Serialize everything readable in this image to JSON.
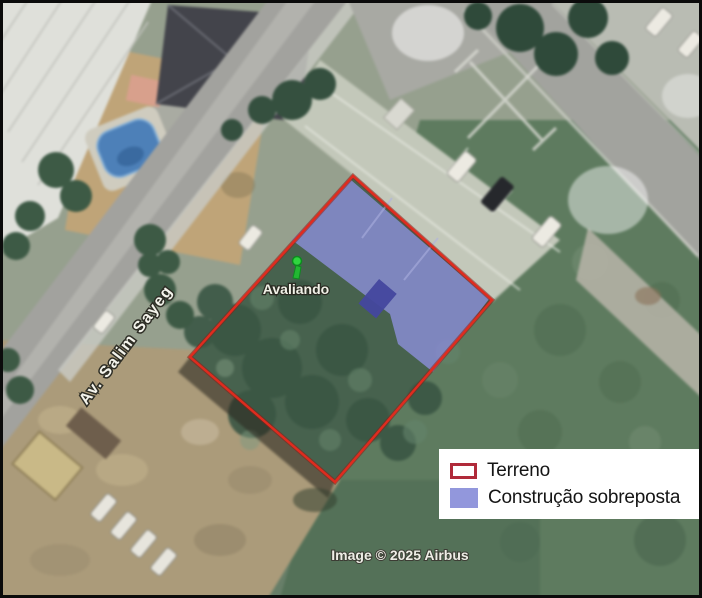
{
  "map": {
    "marker_label": "Avaliando",
    "street_label": "Av. Salim Sayeg",
    "attribution": "Image © 2025 Airbus"
  },
  "legend": {
    "items": [
      {
        "label": "Terreno",
        "swatch": "red-outline"
      },
      {
        "label": "Construção sobreposta",
        "swatch": "purple-fill"
      }
    ]
  },
  "colors": {
    "terreno_outline": "#e02b1e",
    "terreno_outline_halo": "#8f1a12",
    "construction_fill": "#868bce",
    "construction_dark": "#44479e",
    "legend_swatch_outline": "#b02a3a",
    "legend_swatch_fill": "#9297dc",
    "marker_green": "#2fd63f"
  }
}
